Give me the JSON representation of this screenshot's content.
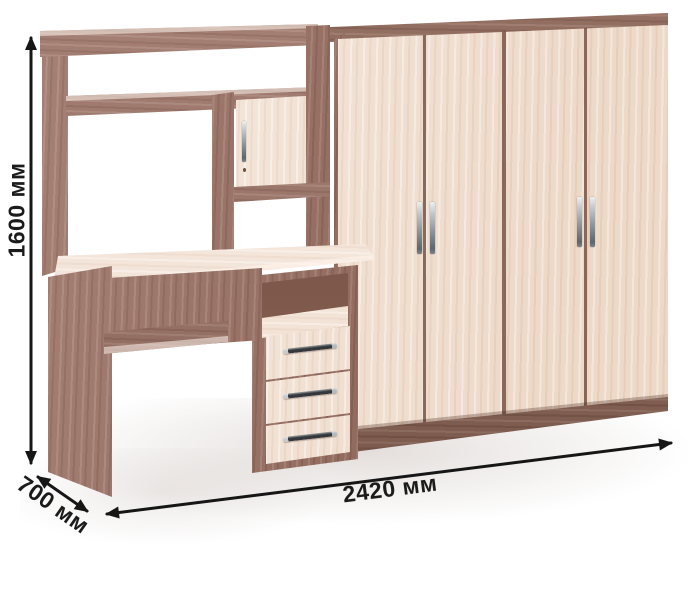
{
  "dimensions": {
    "height": "1600 мм",
    "depth": "700 мм",
    "width": "2420 мм"
  },
  "colors": {
    "background": "#ffffff",
    "dark_wood": "#9b7164",
    "dark_wood_deep": "#8a6354",
    "light_wood": "#f2e1d2",
    "metal": "#aeb4b8",
    "dimension_line": "#161616",
    "label_text": "#1b1b1b"
  }
}
